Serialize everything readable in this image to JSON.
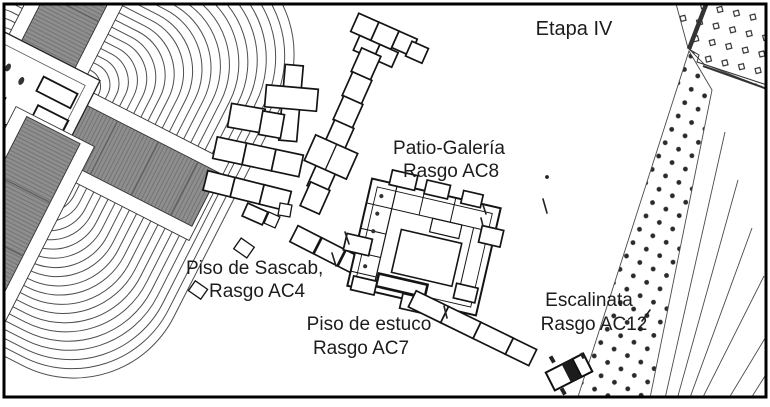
{
  "figure": {
    "type": "archaeological-site-plan",
    "stage_label": "Etapa IV",
    "labels": {
      "stage": "Etapa IV",
      "patio_line1": "Patio-Galería",
      "patio_line2": "Rasgo AC8",
      "sascab_line1": "Piso de Sascab,",
      "sascab_line2": "Rasgo AC4",
      "estuco_line1": "Piso de estuco",
      "estuco_line2": "Rasgo AC7",
      "escalinata_line1": "Escalinata",
      "escalinata_line2": "Rasgo AC12"
    },
    "features": [
      {
        "rasgo": "AC8",
        "name": "Patio-Galería"
      },
      {
        "rasgo": "AC4",
        "name": "Piso de Sascab"
      },
      {
        "rasgo": "AC7",
        "name": "Piso de estuco"
      },
      {
        "rasgo": "AC12",
        "name": "Escalinata"
      }
    ],
    "colors": {
      "background": "#ffffff",
      "border": "#000000",
      "line": "#1a1a1a",
      "stair_fill": "#8e8e8e",
      "contour": "#4d4d4d",
      "stipple_dot": "#2a2a2a"
    }
  }
}
